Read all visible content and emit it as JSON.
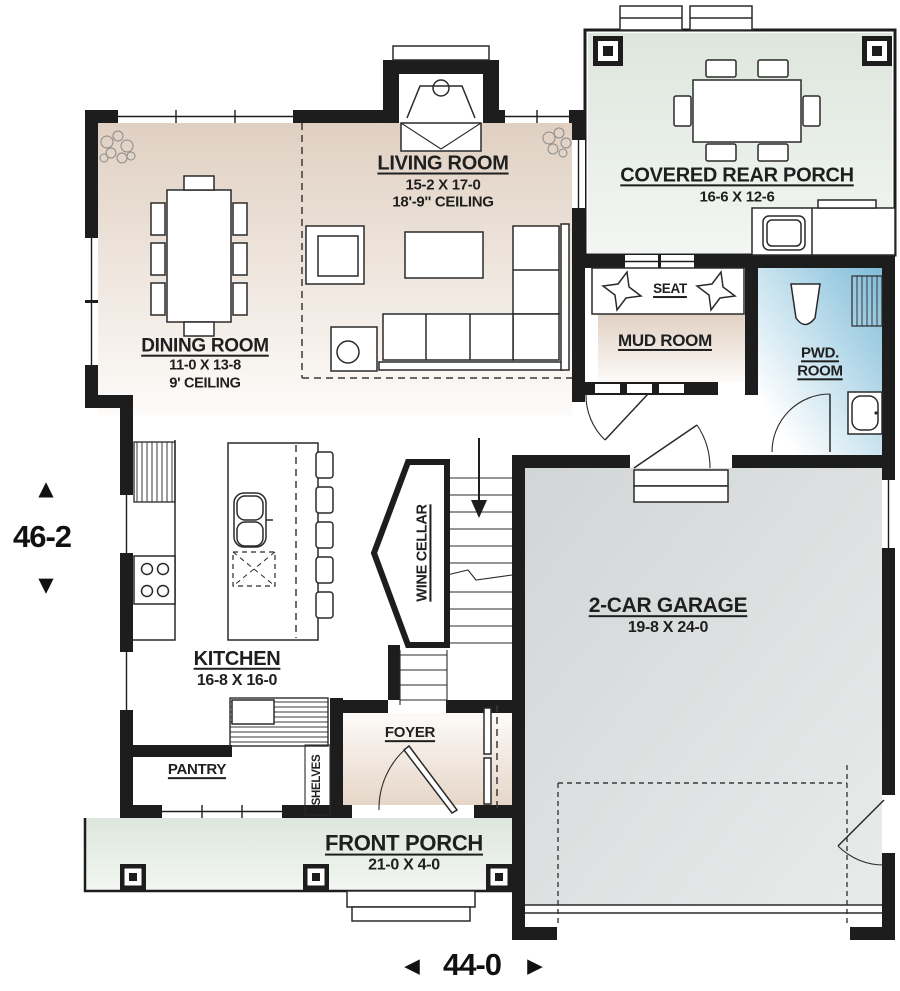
{
  "rooms": {
    "living_room": {
      "name": "LIVING ROOM",
      "size": "15-2 X 17-0",
      "ceiling": "18'-9'' CEILING"
    },
    "dining_room": {
      "name": "DINING ROOM",
      "size": "11-0 X 13-8",
      "ceiling": "9' CEILING"
    },
    "covered_rear_porch": {
      "name": "COVERED REAR PORCH",
      "size": "16-6 X 12-6"
    },
    "mud_room": {
      "name": "MUD ROOM"
    },
    "seat": {
      "name": "SEAT"
    },
    "pwd_room": {
      "line1": "PWD.",
      "line2": "ROOM"
    },
    "garage": {
      "name": "2-CAR GARAGE",
      "size": "19-8 X 24-0"
    },
    "kitchen": {
      "name": "KITCHEN",
      "size": "16-8 X 16-0"
    },
    "pantry": {
      "name": "PANTRY"
    },
    "shelves": {
      "name": "SHELVES"
    },
    "wine_cellar": {
      "name": "WINE CELLAR"
    },
    "foyer": {
      "name": "FOYER"
    },
    "front_porch": {
      "name": "FRONT PORCH",
      "size": "21-0 X 4-0"
    }
  },
  "dimensions": {
    "height": {
      "value": "46-2",
      "arrow_up": "▲",
      "arrow_down": "▼"
    },
    "width": {
      "value": "44-0",
      "arrow_left": "◄",
      "arrow_right": "►"
    }
  },
  "colors": {
    "wall": "#1d1d1d",
    "floor_tan": "#e2d3c6",
    "porch_green": "#e3eae3",
    "garage_gray": "#d5d8d9",
    "pwd_blue": "#7fbcd9"
  }
}
